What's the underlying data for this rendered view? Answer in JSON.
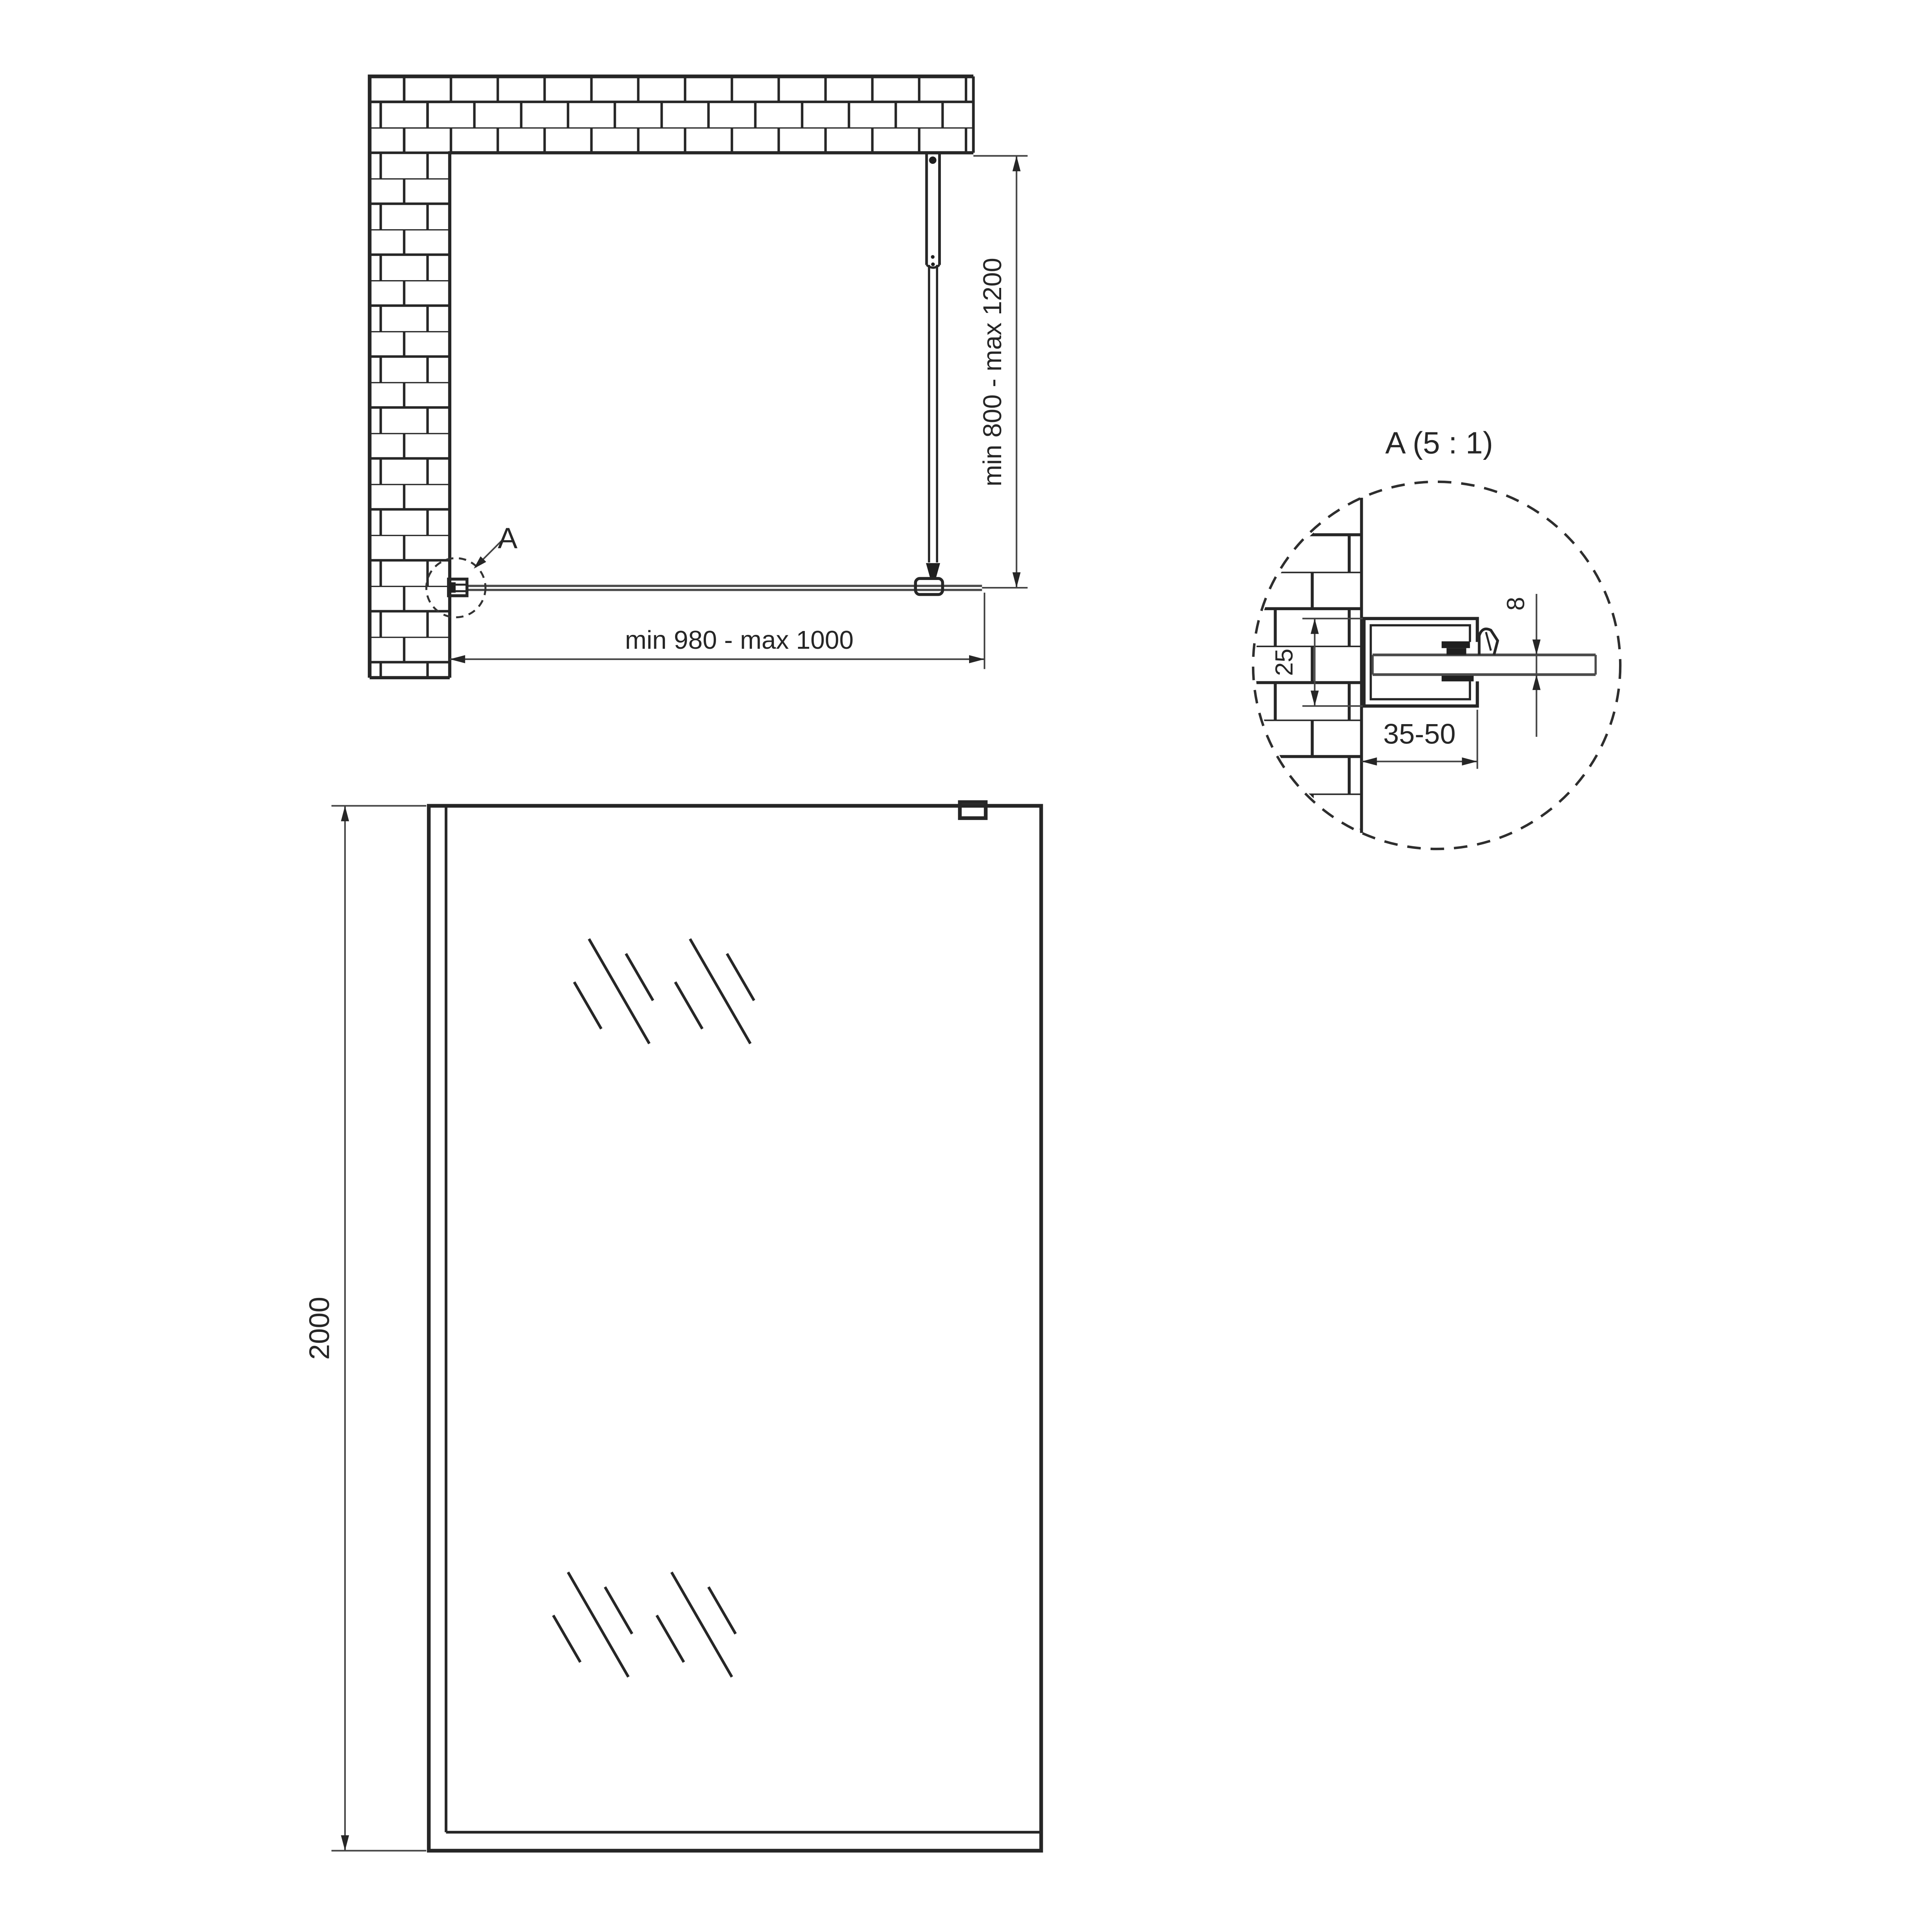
{
  "drawing": {
    "background": "#ffffff",
    "line_color": "#262626",
    "thin_line_color": "#454545",
    "views": {
      "plan": {
        "detail_label": "A",
        "width_dim": "min 980 - max 1000",
        "support_bar_dim": "min 800 - max 1200"
      },
      "front": {
        "height_dim": "2000"
      },
      "detail": {
        "title": "A (5 : 1)",
        "profile_height_dim": "25",
        "glass_thickness_dim": "8",
        "wall_profile_depth_dim": "35-50"
      }
    }
  }
}
